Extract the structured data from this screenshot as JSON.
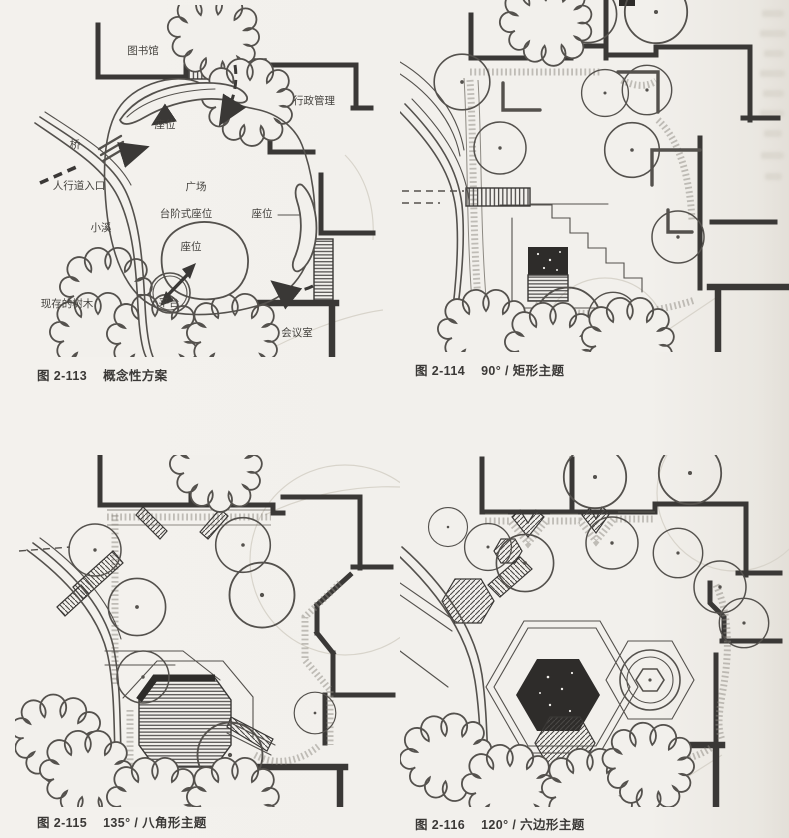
{
  "page": {
    "paper_color": "#f2f0ec",
    "ink_color": "#3a3836",
    "label_color": "#45433f"
  },
  "figures": [
    {
      "id": "2-113",
      "caption_fig": "图 2-113",
      "caption_title": "概念性方案",
      "labels": {
        "library": "图书馆",
        "admin": "行政管理",
        "seat_top": "座位",
        "bridge": "桥",
        "walk_entry": "人行道入口",
        "plaza": "广场",
        "stepped_seat": "台阶式座位",
        "seat_right": "座位",
        "stream": "小溪",
        "seat_center": "座位",
        "existing_trees": "现存的树木",
        "platform": "平台",
        "meeting": "会议室"
      }
    },
    {
      "id": "2-114",
      "caption_fig": "图 2-114",
      "caption_title": "90° / 矩形主题"
    },
    {
      "id": "2-115",
      "caption_fig": "图 2-115",
      "caption_title": "135° / 八角形主题"
    },
    {
      "id": "2-116",
      "caption_fig": "图 2-116",
      "caption_title": "120° / 六边形主题"
    }
  ]
}
